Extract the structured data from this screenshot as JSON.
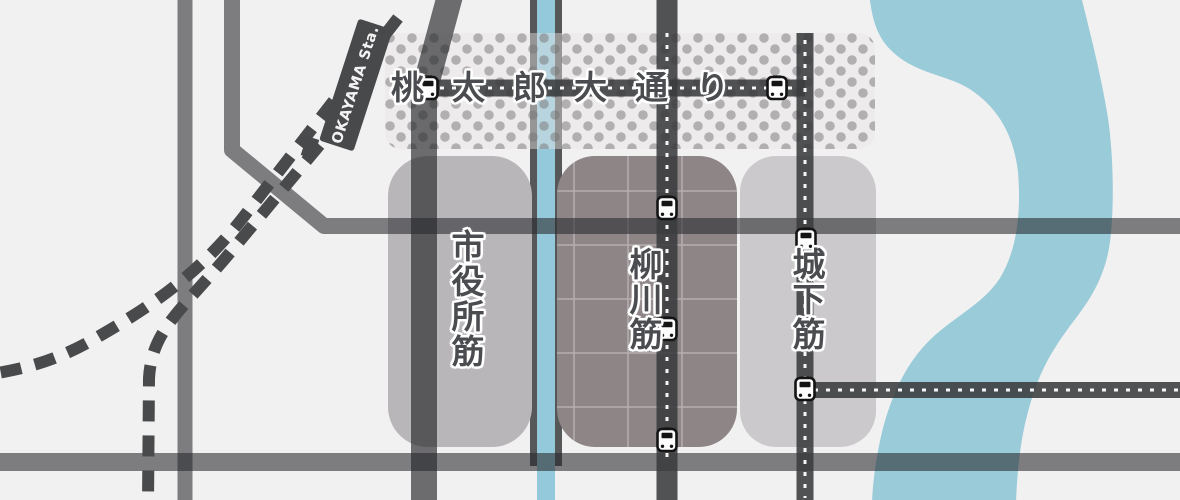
{
  "map": {
    "station": {
      "label": "OKAYAMA Sta."
    },
    "streets": {
      "momotaro_odori": "桃太郎大通り",
      "shiyakusho_suji": "市役所筋",
      "yanagawa_suji": "柳川筋",
      "shiroshita_suji": "城下筋"
    },
    "icons": {
      "tram_stop": "tram-stop-icon"
    },
    "colors": {
      "background": "#f2f1f1",
      "river": "#99cbd9",
      "canal_water": "#93c9da",
      "canal_bank": "#565758",
      "road_plain": "#7a7b7d",
      "road_tram": "#58595b",
      "railway": "#494a4c",
      "avenue_zone_dot": "#b5b2b4",
      "block_city_hall": "#b9b6b9",
      "block_yanagawa": "#8e8587",
      "block_shiroshita": "#cbc9cb",
      "label_text": "#4b4c4f",
      "station_badge": "#48494b"
    }
  }
}
